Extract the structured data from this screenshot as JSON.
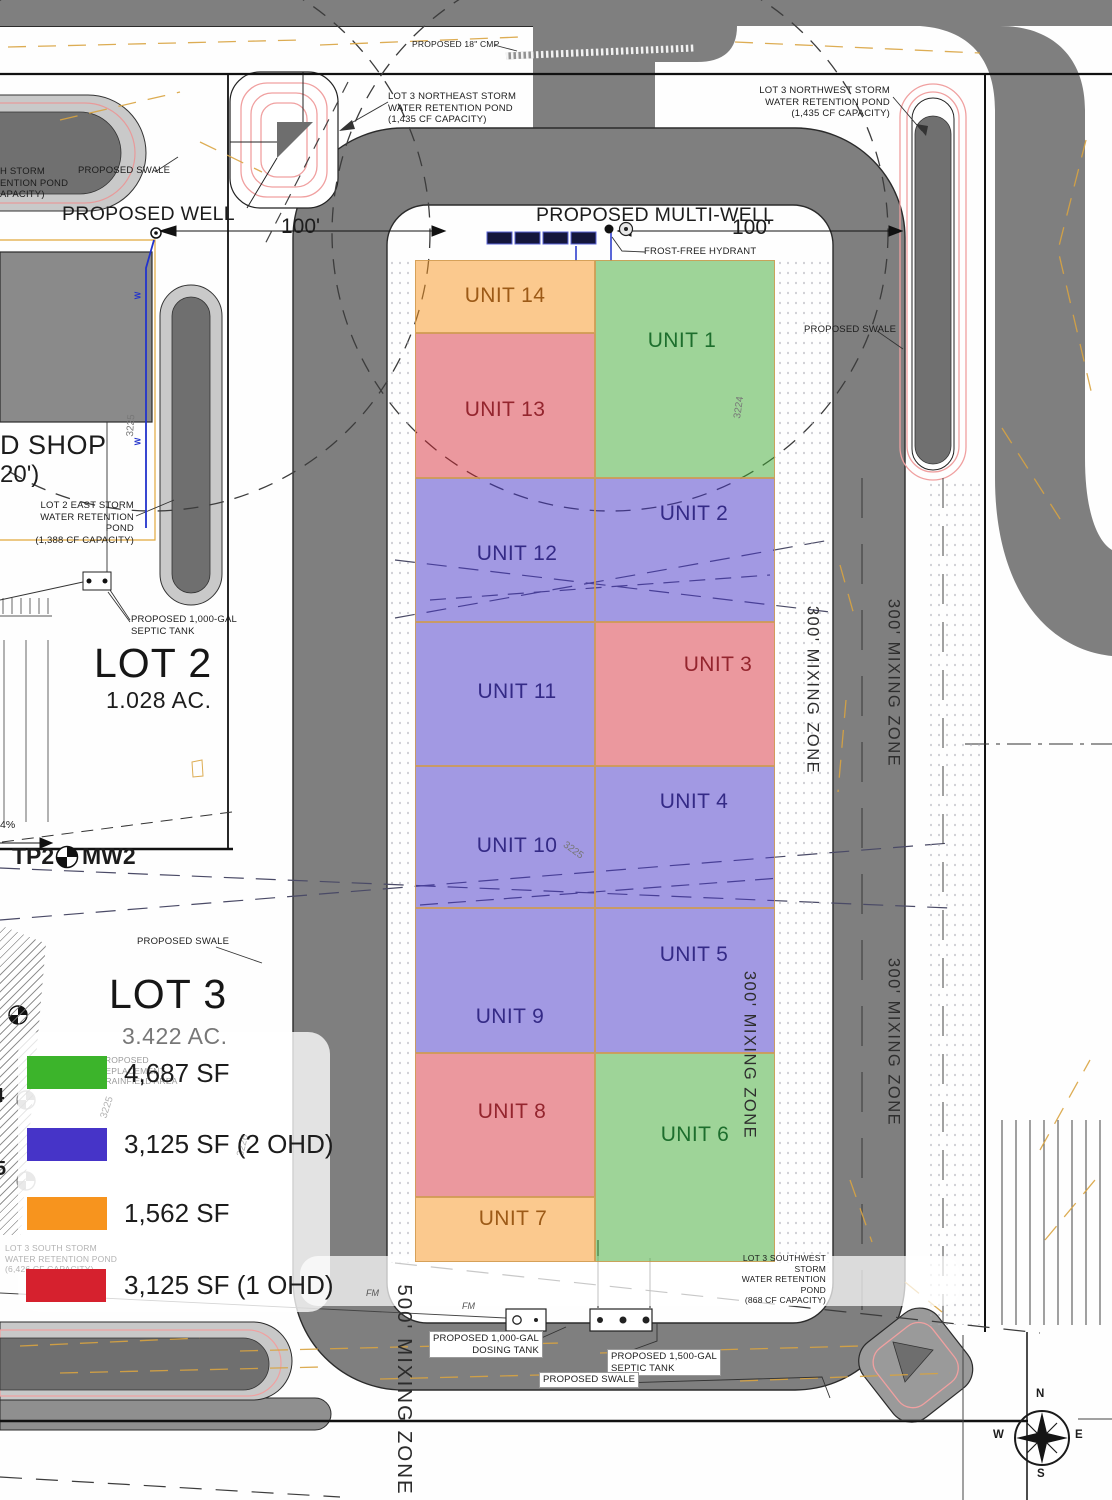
{
  "units": {
    "u1": "UNIT 1",
    "u2": "UNIT 2",
    "u3": "UNIT 3",
    "u4": "UNIT 4",
    "u5": "UNIT 5",
    "u6": "UNIT 6",
    "u7": "UNIT 7",
    "u8": "UNIT 8",
    "u9": "UNIT 9",
    "u10": "UNIT 10",
    "u11": "UNIT 11",
    "u12": "UNIT 12",
    "u13": "UNIT 13",
    "u14": "UNIT 14"
  },
  "legend": {
    "items": [
      {
        "label": "4,687 SF",
        "color": "#3cb42b",
        "applies_to": "green units"
      },
      {
        "label": "3,125 SF (2 OHD)",
        "color": "#4634c8",
        "applies_to": "purple units"
      },
      {
        "label": "1,562 SF",
        "color": "#f7941e",
        "applies_to": "orange units"
      },
      {
        "label": "3,125 SF (1 OHD)",
        "color": "#d6212e",
        "applies_to": "red units"
      }
    ]
  },
  "lots": {
    "lot2_name": "LOT 2",
    "lot2_area": "1.028 AC.",
    "lot3_name": "LOT 3",
    "lot3_area": "3.422 AC."
  },
  "ann": {
    "cmp": "PROPOSED 18\" CMP",
    "ne_pond": "LOT 3 NORTHEAST STORM\nWATER RETENTION POND\n(1,435 CF CAPACITY)",
    "nw_pond": "LOT 3 NORTHWEST STORM\nWATER RETENTION POND\n(1,435 CF CAPACITY)",
    "sw_pond": "LOT 3 SOUTHWEST STORM\nWATER RETENTION POND\n(868 CF CAPACITY)",
    "s_pond": "LOT 3 SOUTH STORM\nWATER RETENTION POND\n(6,426 CF CAPACITY)",
    "lot2e_pond": "LOT 2 EAST STORM\nWATER RETENTION POND\n(1,388 CF CAPACITY)",
    "edge_pond": "H STORM\nENTION POND\nAPACITY)",
    "well": "PROPOSED WELL",
    "multiwell": "PROPOSED MULTI-WELL",
    "hydrant": "FROST-FREE HYDRANT",
    "swale": "PROPOSED SWALE",
    "septic1000": "PROPOSED 1,000-GAL\nSEPTIC TANK",
    "dosing1000": "PROPOSED 1,000-GAL\nDOSING TANK",
    "septic1500": "PROPOSED 1,500-GAL\nSEPTIC TANK",
    "drainfield": "PROPOSED\nREPLACEMENT\nDRAINFIELD AREA",
    "shop_d": "D SHOP",
    "shop_dim": "20')",
    "dim100": "100'",
    "mz300": "300' MIXING ZONE",
    "mz500": "500' MIXING ZONE",
    "tp2": "TP2",
    "mw2": "MW2",
    "slope": "4%",
    "fm": "FM",
    "w": "W",
    "c3224": "3224",
    "c3225": "3225",
    "c3226": "3226",
    "frag4": "4",
    "frag5": "5"
  },
  "compass": {
    "n": "N",
    "e": "E",
    "s": "S",
    "w": "W"
  }
}
